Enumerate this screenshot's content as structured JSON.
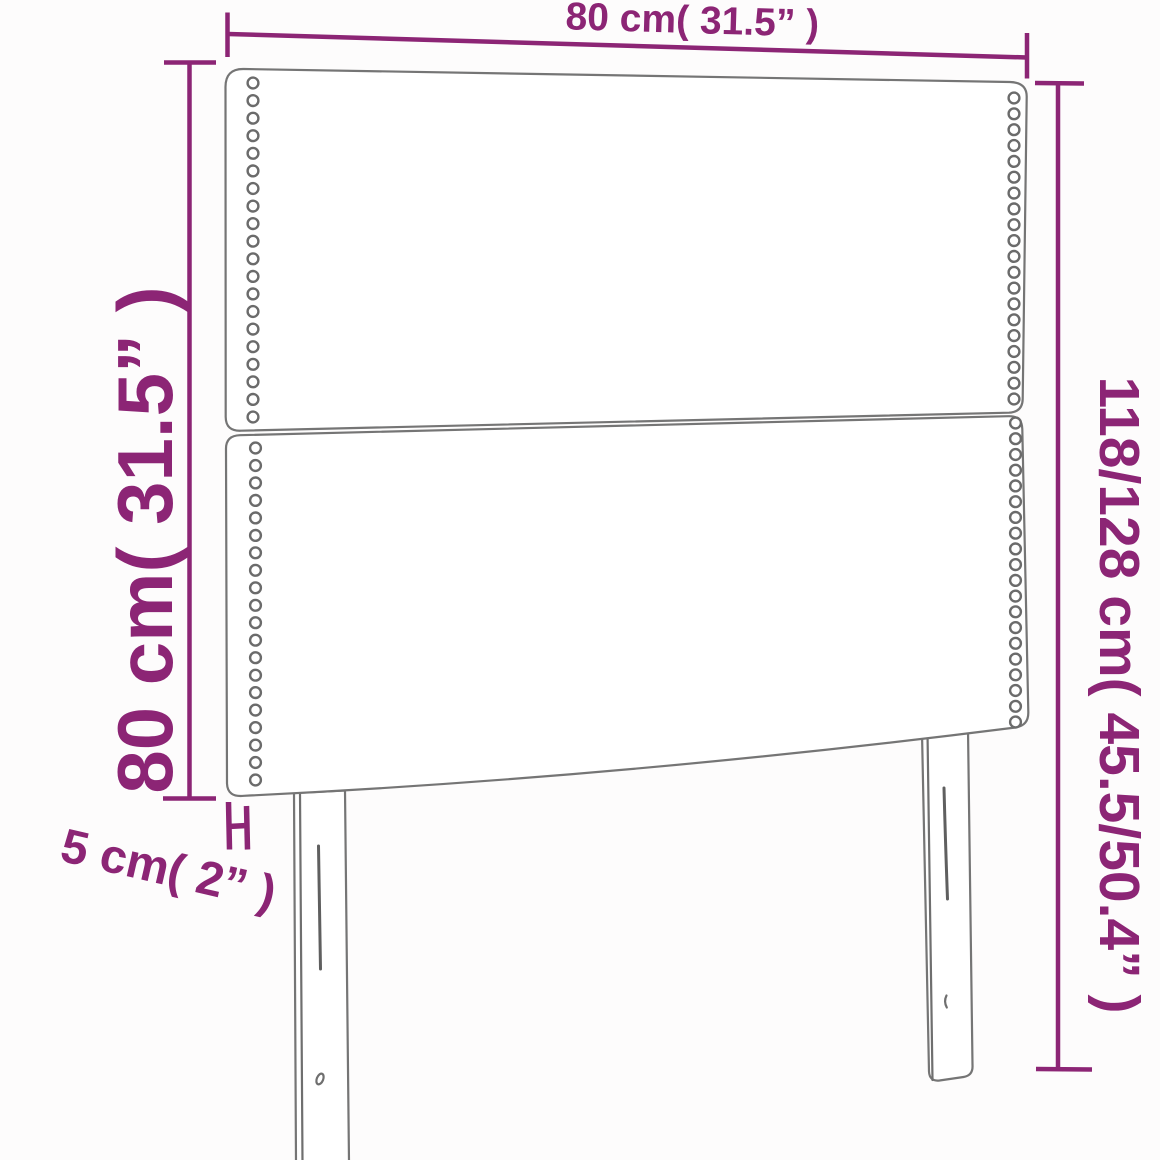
{
  "title": "headboard-dimension-diagram",
  "colors": {
    "dimension_purple": "#8c2575",
    "outline_gray": "#757575",
    "background": "#fdfcfc"
  },
  "dimensions": {
    "width": {
      "cm": "80",
      "inches": "31.5"
    },
    "panel_height": {
      "cm": "80",
      "inches": "31.5"
    },
    "total_height": {
      "cm": "118/128",
      "inches": "45.5/50.4"
    },
    "depth": {
      "cm": "5",
      "inches": "2"
    }
  },
  "labels": {
    "width": "80 cm( 31.5” )",
    "panel_height": "80 cm( 31.5” )",
    "total_height": "118/128 cm( 45.5/50.4” )",
    "depth": "5 cm( 2” )"
  },
  "diagram": {
    "panels": 2,
    "legs": 2,
    "nailhead_columns": [
      {
        "name": "upper-left",
        "x": 253,
        "y1": 83,
        "y2": 417,
        "count": 20
      },
      {
        "name": "lower-left",
        "x": 255.5,
        "y1": 448,
        "y2": 780,
        "count": 20
      },
      {
        "name": "upper-right",
        "x": 1014,
        "y1": 98,
        "y2": 399,
        "count": 20
      },
      {
        "name": "lower-right",
        "x": 1015.5,
        "y1": 423,
        "y2": 722,
        "count": 20
      }
    ],
    "dot_radius": 5.4
  }
}
